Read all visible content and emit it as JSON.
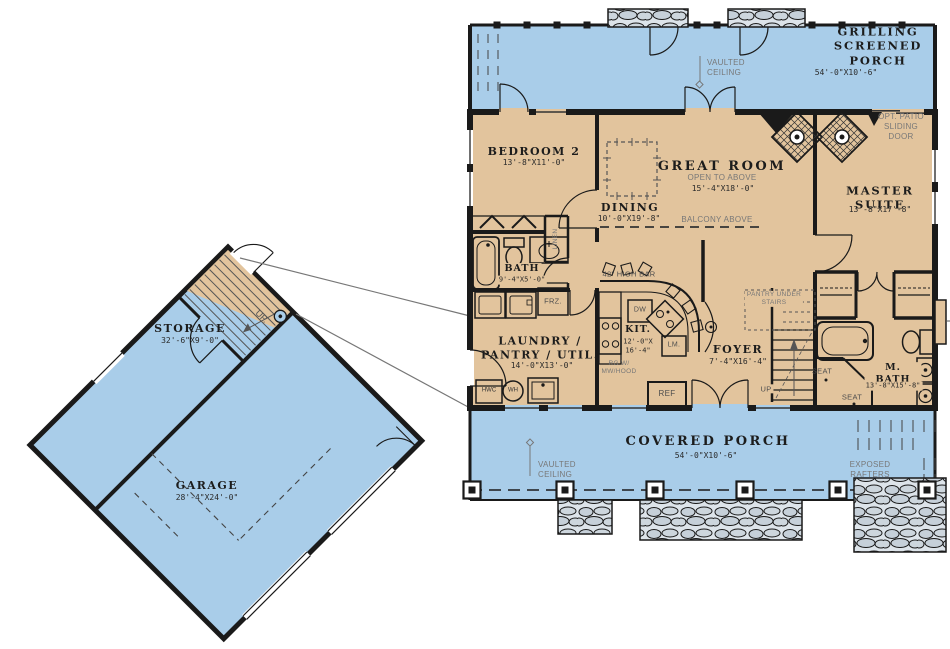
{
  "title": "First floor plan",
  "colors": {
    "porch_blue": "#A9CDE9",
    "interior_tan": "#E2C49D",
    "wall_black": "#1a1a1a",
    "gray_annotation": "#787878",
    "stone_gray": "#C6D0D9"
  },
  "rooms": {
    "grilling_screened_porch": {
      "name": "GRILLING\nSCREENED PORCH",
      "dims": "54'-0\"X10'-6\""
    },
    "bedroom2": {
      "name": "BEDROOM 2",
      "dims": "13'-8\"X11'-0\""
    },
    "great_room": {
      "name": "GREAT ROOM",
      "note": "OPEN TO ABOVE",
      "dims": "15'-4\"X18'-0\""
    },
    "dining": {
      "name": "DINING",
      "dims": "10'-0\"X19'-8\""
    },
    "master_suite": {
      "name": "MASTER SUITE",
      "dims": "13'-8\"X17'-8\""
    },
    "bath": {
      "name": "BATH",
      "dims": "9'-4\"X5'-0\""
    },
    "laundry": {
      "name": "LAUNDRY /\nPANTRY / UTIL.",
      "dims": "14'-0\"X13'-0\""
    },
    "kitchen": {
      "name": "KIT.",
      "dims": "12'-0\"X\n16'-4\""
    },
    "foyer": {
      "name": "FOYER",
      "dims": "7'-4\"X16'-4\""
    },
    "master_bath": {
      "name": "M. BATH",
      "dims": "13'-8\"X15'-8\""
    },
    "covered_porch": {
      "name": "COVERED PORCH",
      "dims": "54'-0\"X10'-6\""
    },
    "storage": {
      "name": "STORAGE",
      "dims": "32'-6\"X9'-0\""
    },
    "garage": {
      "name": "GARAGE",
      "dims": "28'-4\"X24'-0\""
    }
  },
  "annotations": {
    "vaulted_ceiling": "VAULTED\nCEILING",
    "opt_patio": "OPT. PATIO\nSLIDING DOOR",
    "balcony_above": "BALCONY ABOVE",
    "high_bar": "42\" HIGH BAR",
    "pantry_under_stairs": "PANTRY UNDER\nSTAIRS",
    "range_hood": "RG W/\nMW/HOOD",
    "exposed_rafters": "EXPOSED RAFTERS",
    "seat": "SEAT",
    "up": "UP",
    "up_garage": "UP.",
    "linen": "LINEN",
    "appliances": {
      "dw": "DW",
      "ref": "REF",
      "freezer": "FRZ.",
      "lm": "LM.",
      "hwc": "HWC",
      "wh": "WH"
    }
  }
}
